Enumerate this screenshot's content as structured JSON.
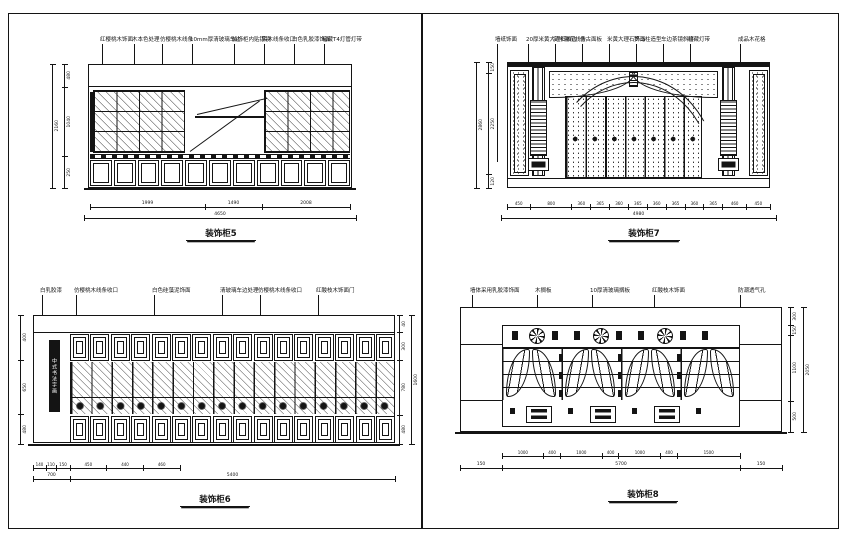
{
  "sheet": {
    "background": "#ffffff",
    "line_color": "#141414"
  },
  "icons": {
    "rosette": "fan-rosette-motif",
    "leaf": "curved-leaf-carving",
    "signboard": "vertical-calligraphy-board"
  },
  "views": {
    "cab5": {
      "title": "装饰柜5",
      "annotations": [
        "红樱桃木饰面",
        "木本色处理",
        "仿樱桃木线条",
        "10mm厚清玻璃车边",
        "装饰柜内贴银镜",
        "实木线条收口",
        "白色乳胶漆饰面",
        "暗藏T4灯管灯带"
      ],
      "dims_bottom": [
        "1999",
        "1490",
        "2008"
      ],
      "dim_overall_bottom": "4650",
      "dims_left": [
        "480",
        "1040",
        "250"
      ],
      "dim_overall_left": "2160"
    },
    "cab7": {
      "title": "装饰柜7",
      "annotations": [
        "墙纸饰面",
        "20厚米黄大理石收边",
        "实木雕花线条",
        "仿古面板",
        "米黄大理石饰面",
        "罗马柱造型",
        "车边茶镜斜拼",
        "暗藏灯带",
        "成品木花格"
      ],
      "dims_bottom": [
        "450",
        "800",
        "360",
        "365",
        "360",
        "365",
        "360",
        "365",
        "360",
        "365",
        "460",
        "450"
      ],
      "dim_overall_bottom": "4980",
      "dims_left": [
        "150",
        "2250",
        "120"
      ],
      "dim_overall_left": "2860"
    },
    "cab6": {
      "title": "装饰柜6",
      "signboard": "中式书法字画",
      "annotations": [
        "白乳胶漆",
        "仿樱桃木线条收口",
        "白色硅藻泥饰面",
        "清玻璃车边处理",
        "仿樱桃木线条收口",
        "红酸枝木饰面门"
      ],
      "dims_bottom": [
        "140",
        "110",
        "150",
        "450",
        "440",
        "460"
      ],
      "dim_subtotal": "700",
      "dim_overall_bottom": "5400",
      "dims_left": [
        "400",
        "650",
        "480"
      ],
      "dims_right": [
        "40",
        "300",
        "780",
        "480"
      ],
      "dim_overall_right": "1600"
    },
    "cab8": {
      "title": "装饰柜8",
      "annotations": [
        "墙体采用乳胶漆饰面",
        "木搁板",
        "10厚清玻璃搁板",
        "红酸枝木饰面",
        "防潮透气孔"
      ],
      "dims_bottom": [
        "1000",
        "400",
        "1000",
        "400",
        "1000",
        "400",
        "1500"
      ],
      "dims_bottom2": [
        "150",
        "5700",
        "150"
      ],
      "dims_right": [
        "300",
        "150",
        "1100",
        "500"
      ],
      "dim_overall_right": "2050"
    }
  }
}
